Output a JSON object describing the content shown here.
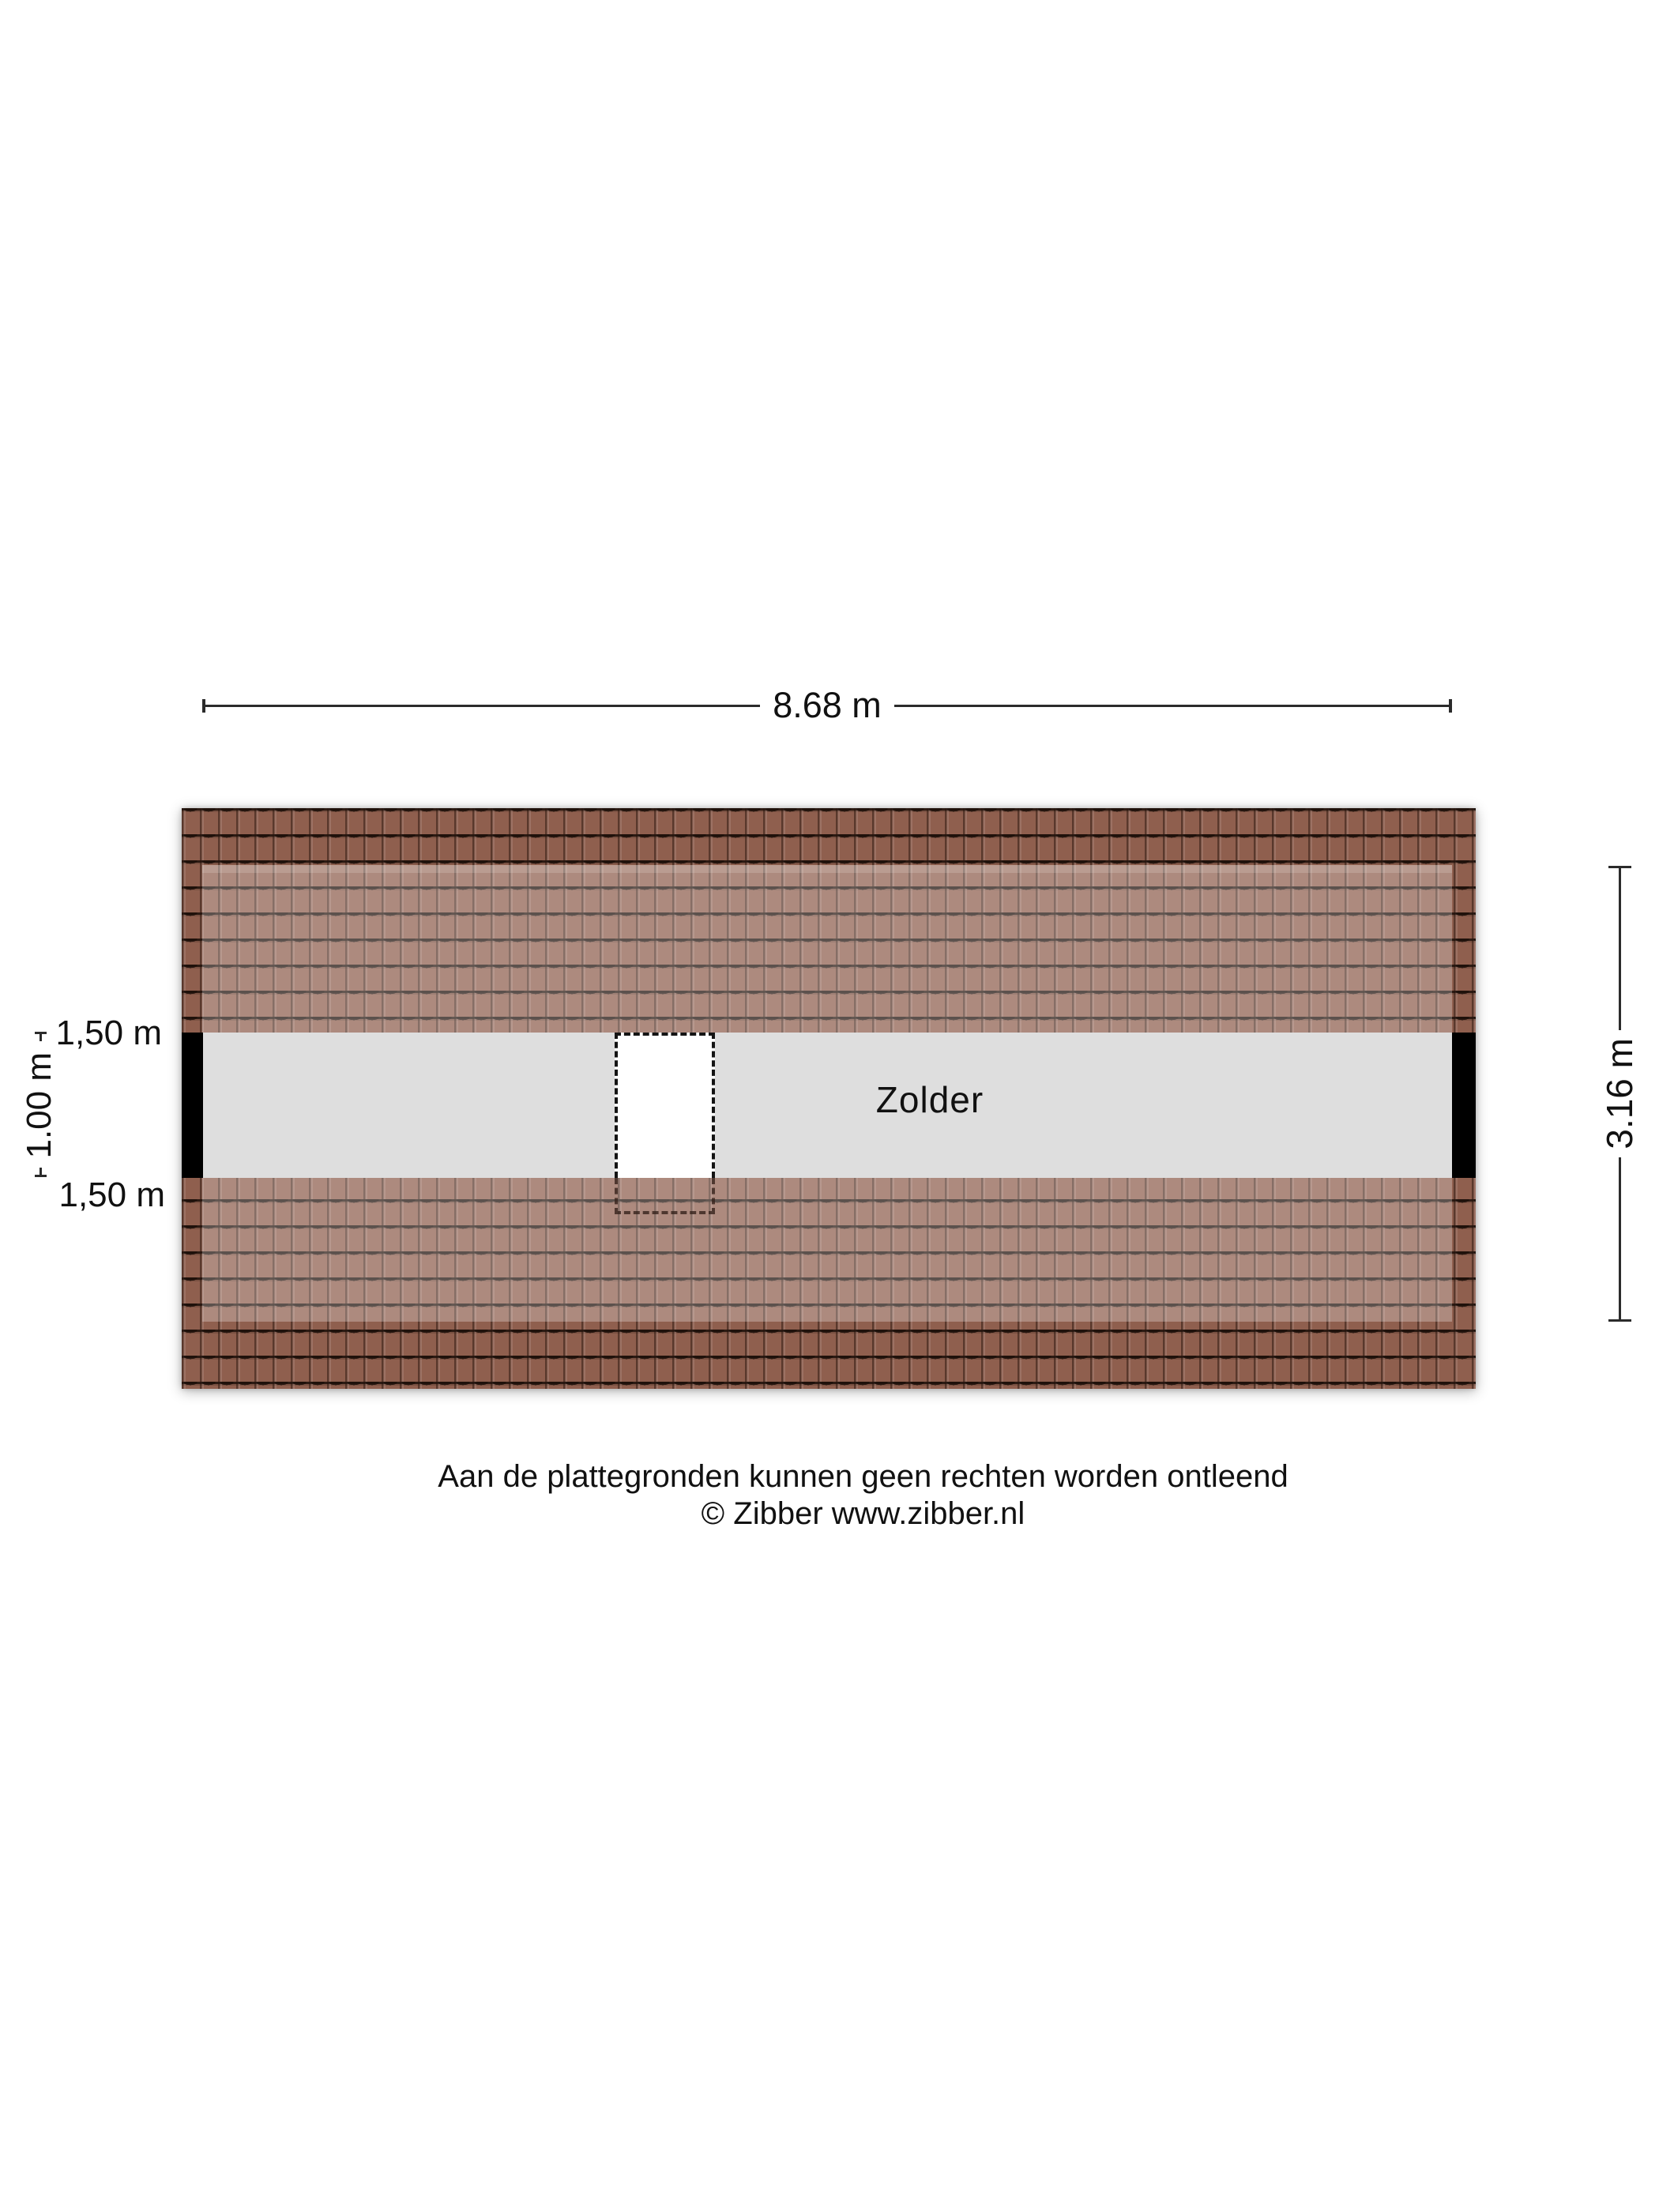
{
  "plan": {
    "room_label": "Zolder",
    "dimensions": {
      "width_label": "8.68 m",
      "depth_label": "3.16 m",
      "floor_width_label": "1.00 m",
      "contour_top_label": "1,50 m",
      "contour_bottom_label": "1,50 m"
    },
    "colors": {
      "tile_dark": "#8f5f4e",
      "floor_gray": "#dedede",
      "wall_black": "#000000",
      "dim_line": "#2b2b2b",
      "text_black": "#111111"
    }
  },
  "footer": {
    "line1": "Aan de plattegronden kunnen geen rechten worden ontleend",
    "line2": "© Zibber www.zibber.nl"
  }
}
